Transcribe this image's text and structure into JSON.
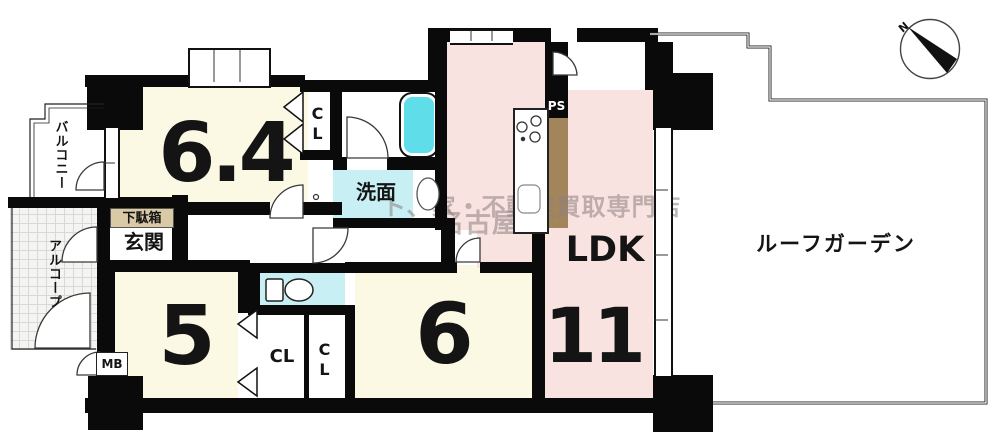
{
  "rooms": {
    "bedroom_64": {
      "label": "6.4"
    },
    "bedroom_5": {
      "label": "5"
    },
    "bedroom_6": {
      "label": "6"
    },
    "ldk": {
      "label": "LDK",
      "size_label": "11"
    },
    "washroom": {
      "label": "洗面"
    },
    "entrance": {
      "label": "玄関"
    },
    "shoe_box": {
      "label": "下駄箱"
    },
    "balcony": {
      "label": "バルコニー"
    },
    "alcove": {
      "label": "アルコープ"
    },
    "roof_garden": {
      "label": "ルーフガーデン"
    },
    "closet_64": {
      "label": "CL"
    },
    "closet_5": {
      "label": "CL"
    },
    "closet_6": {
      "label": "CL"
    },
    "meter_box": {
      "label": "MB"
    },
    "pipe_shaft": {
      "label": "PS"
    }
  },
  "compass": {
    "north_label": "N"
  },
  "watermark": {
    "prefix": "ト、",
    "line1": "家・不動産買取専門店",
    "line2": "名古屋"
  },
  "colors": {
    "room_cream": "#FBF8E3",
    "ldk_pink": "#F8E3E1",
    "wet_area_cyan": "#C8EFF3",
    "bathtub_cyan": "#5FDEE9",
    "pipe_space_brown": "#A2855B",
    "shoe_box_tan": "#D9C9A5",
    "wall_black": "#0A0A0A"
  }
}
